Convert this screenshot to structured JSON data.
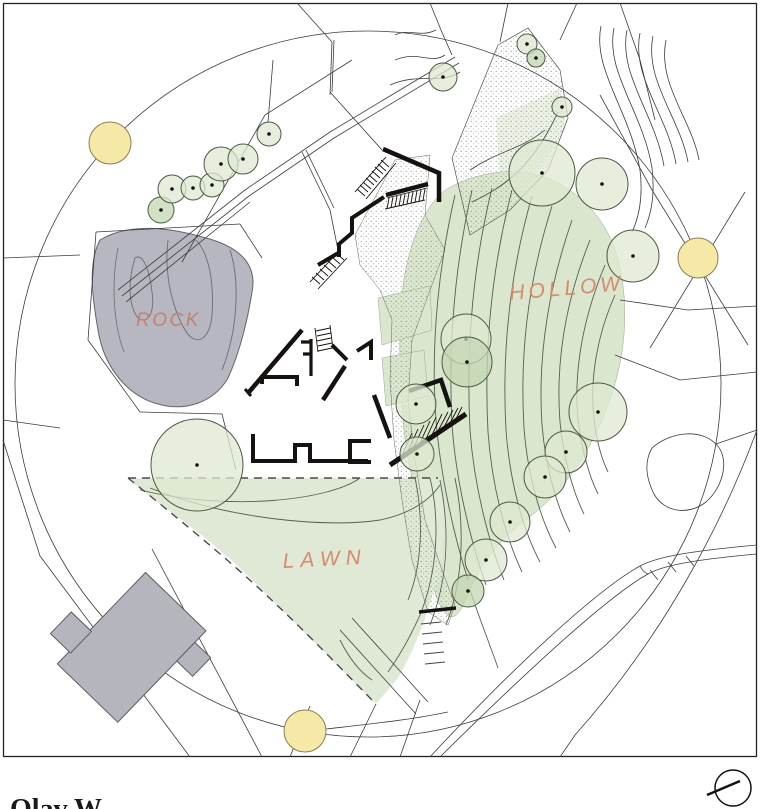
{
  "labels": {
    "rock": "ROCK",
    "hollow": "HOLLOW",
    "lawn": "LAWN"
  },
  "caption": "Olav W",
  "colors": {
    "label_color": "#d88a6c",
    "line_color": "#3c3c3c",
    "wall_color": "#16120f",
    "rock_fill": "#b6b7c0",
    "rock_stroke": "#63646e",
    "hollow_fill": "#dbe6cf",
    "lawn_fill": "#e0e9d5",
    "tree_fill_light": "#dfe8d2",
    "tree_fill_dark": "#c3d6b2",
    "tree_stroke": "#4b5a42",
    "yellow_fill": "#f6e8a6",
    "yellow_stroke": "#8a7f55",
    "neighbor_building_fill": "#b4b5bd"
  },
  "trees": [
    {
      "x": 161,
      "y": 210,
      "r": 13,
      "shade": "dark"
    },
    {
      "x": 172,
      "y": 189,
      "r": 14,
      "shade": "light"
    },
    {
      "x": 193,
      "y": 188,
      "r": 12,
      "shade": "light"
    },
    {
      "x": 212,
      "y": 185,
      "r": 12,
      "shade": "light"
    },
    {
      "x": 221,
      "y": 164,
      "r": 17,
      "shade": "light"
    },
    {
      "x": 243,
      "y": 159,
      "r": 15,
      "shade": "light"
    },
    {
      "x": 269,
      "y": 134,
      "r": 12,
      "shade": "light"
    },
    {
      "x": 443,
      "y": 77,
      "r": 14,
      "shade": "light"
    },
    {
      "x": 527,
      "y": 44,
      "r": 10,
      "shade": "light"
    },
    {
      "x": 536,
      "y": 58,
      "r": 9,
      "shade": "dark"
    },
    {
      "x": 562,
      "y": 107,
      "r": 10,
      "shade": "light"
    },
    {
      "x": 542,
      "y": 173,
      "r": 33,
      "shade": "light"
    },
    {
      "x": 602,
      "y": 184,
      "r": 26,
      "shade": "light"
    },
    {
      "x": 633,
      "y": 256,
      "r": 26,
      "shade": "light"
    },
    {
      "x": 598,
      "y": 412,
      "r": 29,
      "shade": "light"
    },
    {
      "x": 566,
      "y": 452,
      "r": 21,
      "shade": "light"
    },
    {
      "x": 466,
      "y": 339,
      "r": 25,
      "shade": "light"
    },
    {
      "x": 467,
      "y": 362,
      "r": 25,
      "shade": "dark"
    },
    {
      "x": 416,
      "y": 404,
      "r": 20,
      "shade": "light"
    },
    {
      "x": 417,
      "y": 454,
      "r": 17,
      "shade": "light"
    },
    {
      "x": 545,
      "y": 477,
      "r": 21,
      "shade": "light"
    },
    {
      "x": 510,
      "y": 522,
      "r": 20,
      "shade": "light"
    },
    {
      "x": 486,
      "y": 560,
      "r": 21,
      "shade": "light"
    },
    {
      "x": 468,
      "y": 591,
      "r": 16,
      "shade": "dark"
    },
    {
      "x": 197,
      "y": 465,
      "r": 46,
      "shade": "light"
    }
  ],
  "yellow_markers": [
    {
      "x": 110,
      "y": 143,
      "r": 21
    },
    {
      "x": 698,
      "y": 258,
      "r": 20
    },
    {
      "x": 305,
      "y": 731,
      "r": 21
    }
  ],
  "compass": {
    "cx": 733,
    "cy": 788,
    "r": 18
  }
}
